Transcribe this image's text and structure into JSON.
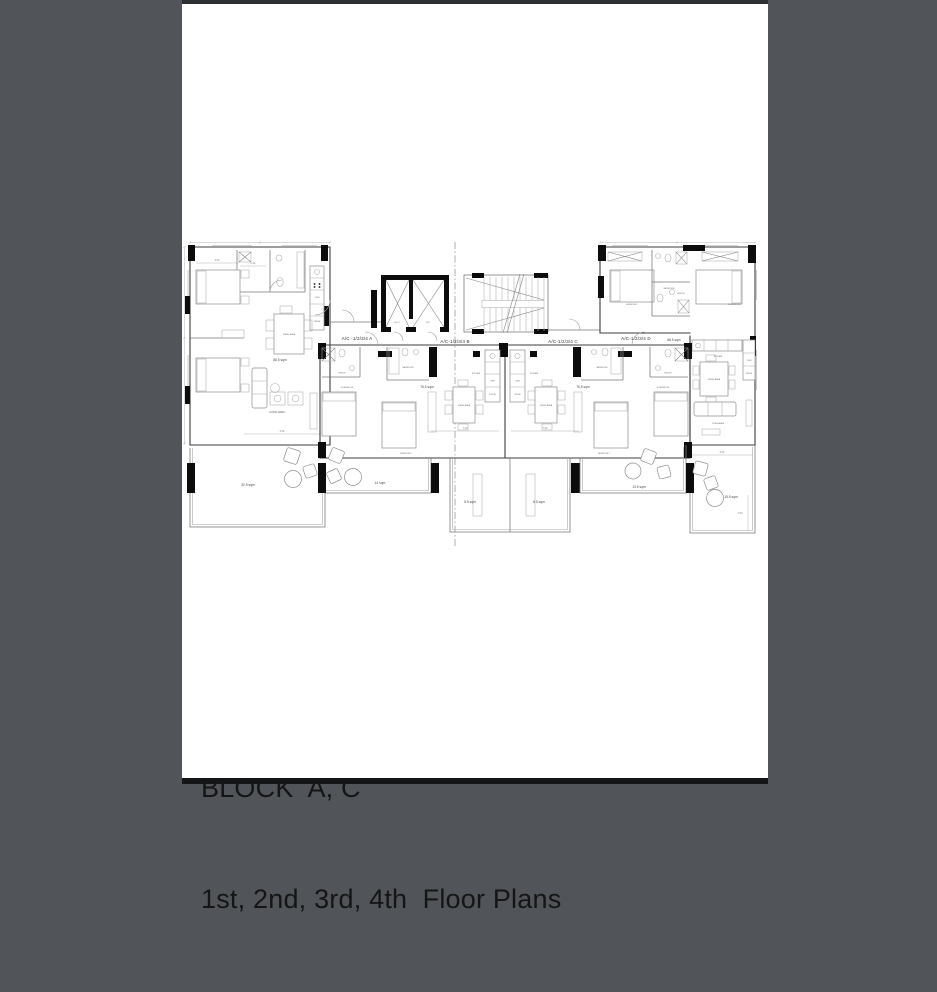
{
  "page": {
    "background_color": "#515458",
    "paper_color": "#ffffff"
  },
  "title_block": {
    "line1": "BLOCK  A、C",
    "line2": "1st、2nd、3rd、4th  Floor Plans"
  },
  "plan": {
    "units": [
      {
        "id": "unit-a",
        "label": "A/C -1/2/3/4 A",
        "area": "88.5 sqm"
      },
      {
        "id": "unit-b",
        "label": "A/C-1/2/3/4 B",
        "area": "76.5 sqm"
      },
      {
        "id": "unit-c",
        "label": "A/C-1/2/3/4 C",
        "area": "76.5 sqm"
      },
      {
        "id": "unit-d",
        "label": "A/C-1/2/3/4 D",
        "area": "88.5 sqm"
      }
    ],
    "rooms": {
      "m_bedroom": "M. BEDROOM",
      "bedroom2": "BEDROOM 2",
      "bathroom": "BATHROOM",
      "ensuite": "ENSUITE",
      "kitchen": "KITCHEN",
      "dining": "DINING AREA",
      "living": "LIVING AREA",
      "duct": "DUCT",
      "lift": "LIFT",
      "oven": "OVEN",
      "fridge": "FRIDGE"
    },
    "outdoor": {
      "terrace_a": "32.5 sqm",
      "balcony_b": "14 sqm",
      "balcony_c_left": "8.5 sqm",
      "balcony_c_right": "8.5 sqm",
      "balcony_d": "13.5 sqm",
      "terrace_d": "15.5 sqm"
    },
    "dims": {
      "a": "3.50",
      "b": "1.40",
      "c": "7.20",
      "d": "4.00",
      "e": "2.50",
      "f": "4.90"
    }
  }
}
